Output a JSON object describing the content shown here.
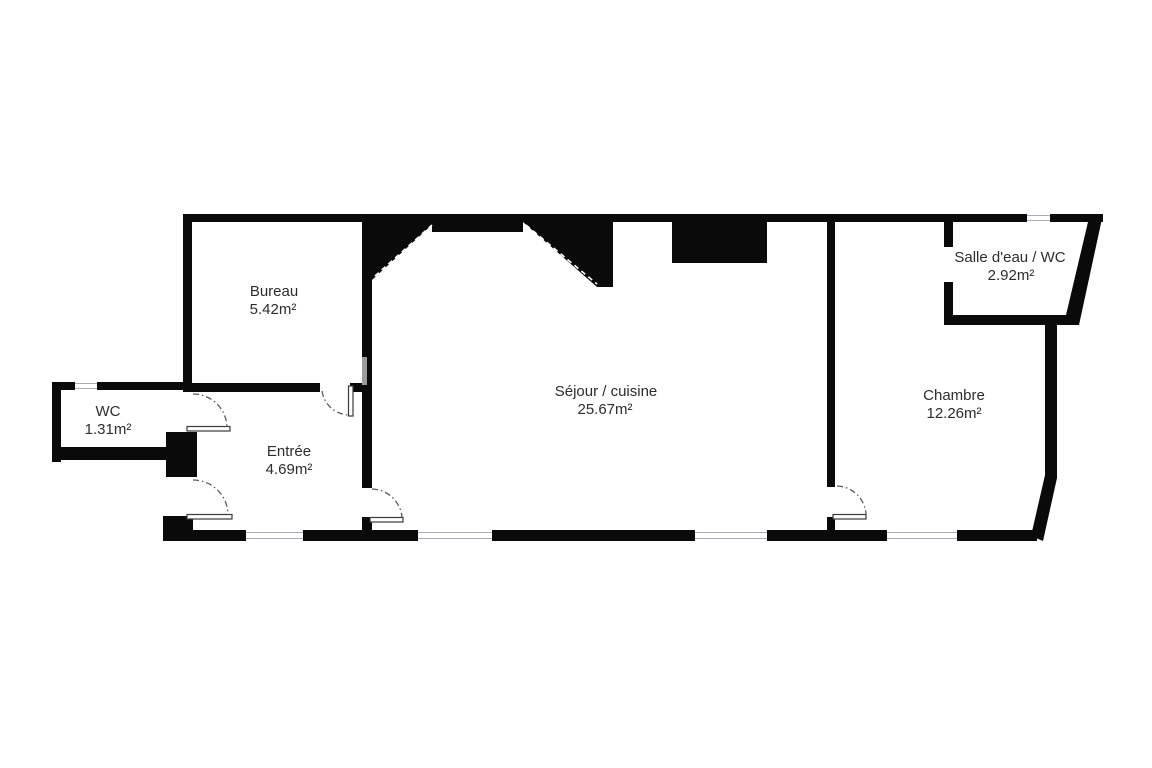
{
  "plan": {
    "type": "apartment-floor-plan",
    "rooms": [
      {
        "id": "bureau",
        "name": "Bureau",
        "area": "5.42m²"
      },
      {
        "id": "wc",
        "name": "WC",
        "area": "1.31m²"
      },
      {
        "id": "entree",
        "name": "Entrée",
        "area": "4.69m²"
      },
      {
        "id": "sejour",
        "name": "Séjour / cuisine",
        "area": "25.67m²"
      },
      {
        "id": "chambre",
        "name": "Chambre",
        "area": "12.26m²"
      },
      {
        "id": "salle_deau",
        "name": "Salle d'eau / WC",
        "area": "2.92m²"
      }
    ],
    "colors": {
      "wall": "#0a0a0a",
      "background": "#ffffff",
      "label_text": "#2d2d2d",
      "door_arc": "#5a5a5a",
      "window_line": "#a6aebc"
    }
  }
}
